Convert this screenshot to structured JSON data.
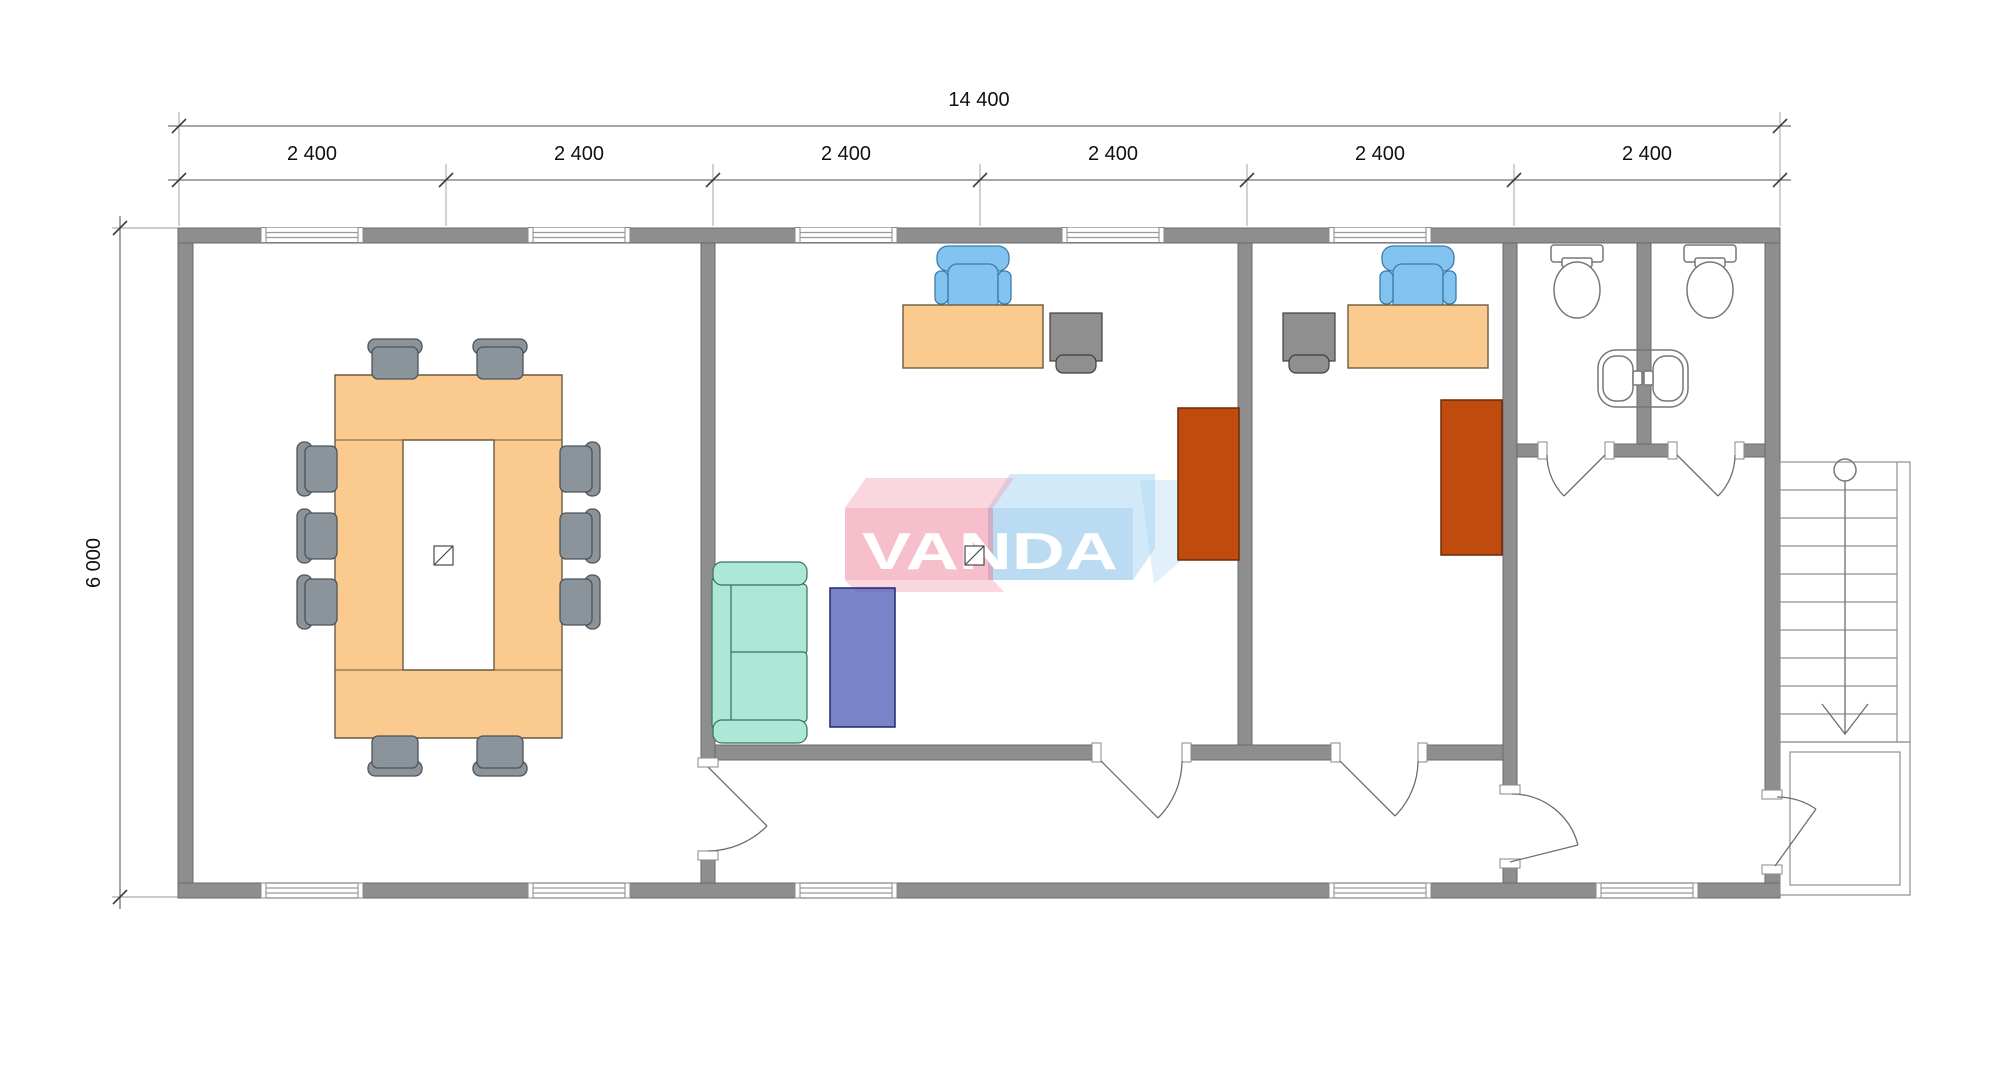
{
  "document": {
    "kind": "architectural floor plan drawing",
    "watermark_text": "VANDA"
  },
  "dimensions": {
    "total_width": "14 400",
    "height": "6 000",
    "bays": [
      "2 400",
      "2 400",
      "2 400",
      "2 400",
      "2 400",
      "2 400"
    ]
  },
  "plan_contents": {
    "rooms": [
      "conference room",
      "open office",
      "private office",
      "two wc stalls",
      "entry hall",
      "corridor"
    ],
    "conference_room_items": [
      "u-shaped conference table",
      "10 chairs",
      "floor drain symbol"
    ],
    "open_office_items": [
      "desk",
      "blue swivel chair",
      "desk pedestal",
      "sofa",
      "coffee table",
      "tall cabinet",
      "floor drain symbol"
    ],
    "private_office_items": [
      "desk",
      "blue swivel chair",
      "desk pedestal",
      "tall cabinet"
    ],
    "wc_items": [
      "2 toilets",
      "back-to-back wash basins"
    ],
    "exterior_items": [
      "staircase with direction arrow",
      "entrance landing"
    ]
  },
  "colors": {
    "wall_fill": "#8e8e8e",
    "wall_edge": "#6a6a6a",
    "table_fill": "#fbca8e",
    "table_edge": "#6b5b40",
    "gray_chair_fill": "#8b939b",
    "gray_chair_edge": "#4d545b",
    "blue_chair_fill": "#82c3ef",
    "blue_chair_edge": "#3b7cab",
    "cabinet_fill": "#8f8f8f",
    "cabinet_edge": "#3f3f3f",
    "sofa_fill": "#abe8d6",
    "sofa_edge": "#37705f",
    "coffee_table_fill": "rgba(70,86,180,0.72)",
    "coffee_table_edge": "#1f2a6b",
    "wardrobe_fill": "#bf4c0e",
    "wardrobe_edge": "#6f2807",
    "fixture_edge": "#777777",
    "thin_line": "#6f6f6f",
    "stair_line": "#8f8f8f",
    "dim_line": "#4c4c4c",
    "dim_text": "#111111",
    "logo_pink_front": "rgba(238,118,147,0.47)",
    "logo_pink_top": "rgba(242,152,172,0.40)",
    "logo_blue_front": "rgba(118,184,229,0.50)",
    "logo_blue_top": "rgba(152,206,240,0.45)",
    "logo_echo": "rgba(160,205,235,0.30)",
    "logo_text": "#ffffff"
  }
}
